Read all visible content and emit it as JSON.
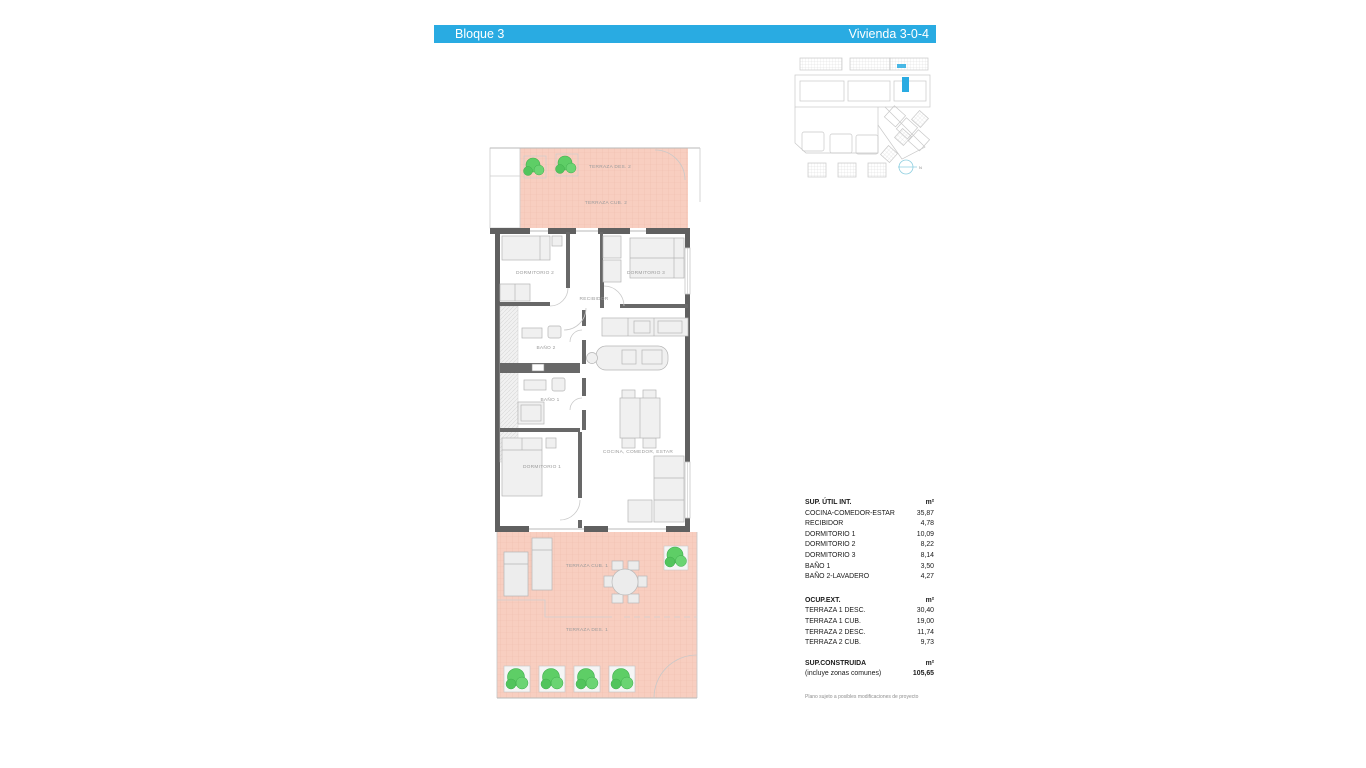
{
  "header": {
    "block_label": "Bloque 3",
    "unit_label": "Vivienda 3-0-4"
  },
  "colors": {
    "accent": "#29ABE2",
    "terrace_fill": "#F8CEC0",
    "wall": "#606060",
    "plant_green": "#5ECE66"
  },
  "plan_labels": {
    "terraza_des_2": "TERRAZA DES. 2",
    "terraza_cub_2": "TERRAZA CUB. 2",
    "dormitorio_2": "DORMITORIO 2",
    "dormitorio_3": "DORMITORIO 3",
    "recibidor": "RECIBIDOR",
    "bano_2": "BAÑO 2",
    "bano_1": "BAÑO 1",
    "cocina_comedor_estar": "COCINA, COMEDOR, ESTAR",
    "dormitorio_1": "DORMITORIO 1",
    "terraza_cub_1": "TERRAZA CUB. 1",
    "terraza_des_1": "TERRAZA DES. 1",
    "north": "N"
  },
  "tables": {
    "sup_util": {
      "title": "SUP. ÚTIL INT.",
      "unit": "m²",
      "rows": [
        {
          "label": "COCINA-COMEDOR-ESTAR",
          "value": "35,87"
        },
        {
          "label": "RECIBIDOR",
          "value": "4,78"
        },
        {
          "label": "DORMITORIO 1",
          "value": "10,09"
        },
        {
          "label": "DORMITORIO 2",
          "value": "8,22"
        },
        {
          "label": "DORMITORIO 3",
          "value": "8,14"
        },
        {
          "label": "BAÑO 1",
          "value": "3,50"
        },
        {
          "label": "BAÑO 2-LAVADERO",
          "value": "4,27"
        }
      ]
    },
    "ocup_ext": {
      "title": "OCUP.EXT.",
      "unit": "m²",
      "rows": [
        {
          "label": "TERRAZA 1 DESC.",
          "value": "30,40"
        },
        {
          "label": "TERRAZA 1 CUB.",
          "value": "19,00"
        },
        {
          "label": "TERRAZA 2 DESC.",
          "value": "11,74"
        },
        {
          "label": "TERRAZA 2 CUB.",
          "value": "9,73"
        }
      ]
    },
    "sup_construida": {
      "title": "SUP.CONSTRUIDA",
      "unit": "m²",
      "subtitle": "(incluye zonas comunes)",
      "total": "105,65"
    }
  },
  "footnote": "Plano sujeto a posibles modificaciones de proyecto"
}
